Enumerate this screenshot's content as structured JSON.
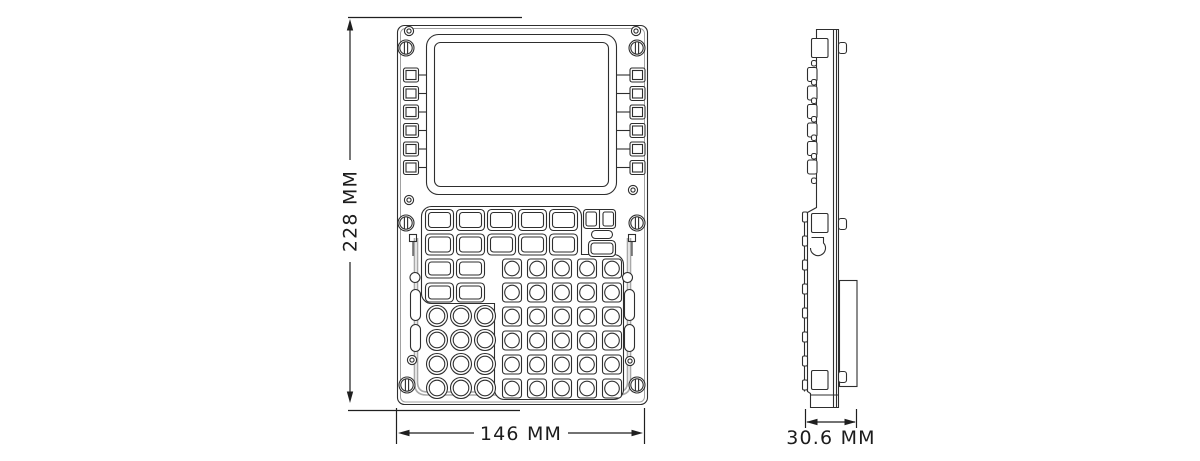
{
  "page": {
    "background": "#ffffff"
  },
  "drawing": {
    "type": "technical-dimension-drawing",
    "subject": "MCDU control display unit",
    "unit": "MM",
    "dimensions": {
      "height": {
        "value": 228,
        "label": "228 MM"
      },
      "width": {
        "value": 146,
        "label": "146 MM"
      },
      "depth": {
        "value": 30.6,
        "label": "30.6 MM"
      }
    },
    "views": {
      "front": {
        "name": "front view",
        "screen": "blank rectangular display",
        "line_select_keys_per_side": 6,
        "function_key_rows": [
          5,
          5,
          2,
          2
        ],
        "alpha_key_grid": {
          "columns": 5,
          "rows": 6
        },
        "round_key_grid": {
          "columns": 3,
          "rows": 4
        },
        "special_keys": [
          "split-double-key",
          "pill-key",
          "wide-rounded-key"
        ],
        "fasteners": {
          "slotted_screws": 6,
          "small_screws": 6,
          "side_slots": 4
        }
      },
      "side": {
        "name": "side view",
        "features": [
          "three front latches",
          "three rear tabs",
          "key profile bumps",
          "rear housing box"
        ]
      }
    },
    "colors": {
      "line": "#2e2e2e",
      "dim": "#1f1f1f",
      "seal": "#a8a8a8",
      "text": "#1c1c1c",
      "background": "#ffffff"
    }
  }
}
